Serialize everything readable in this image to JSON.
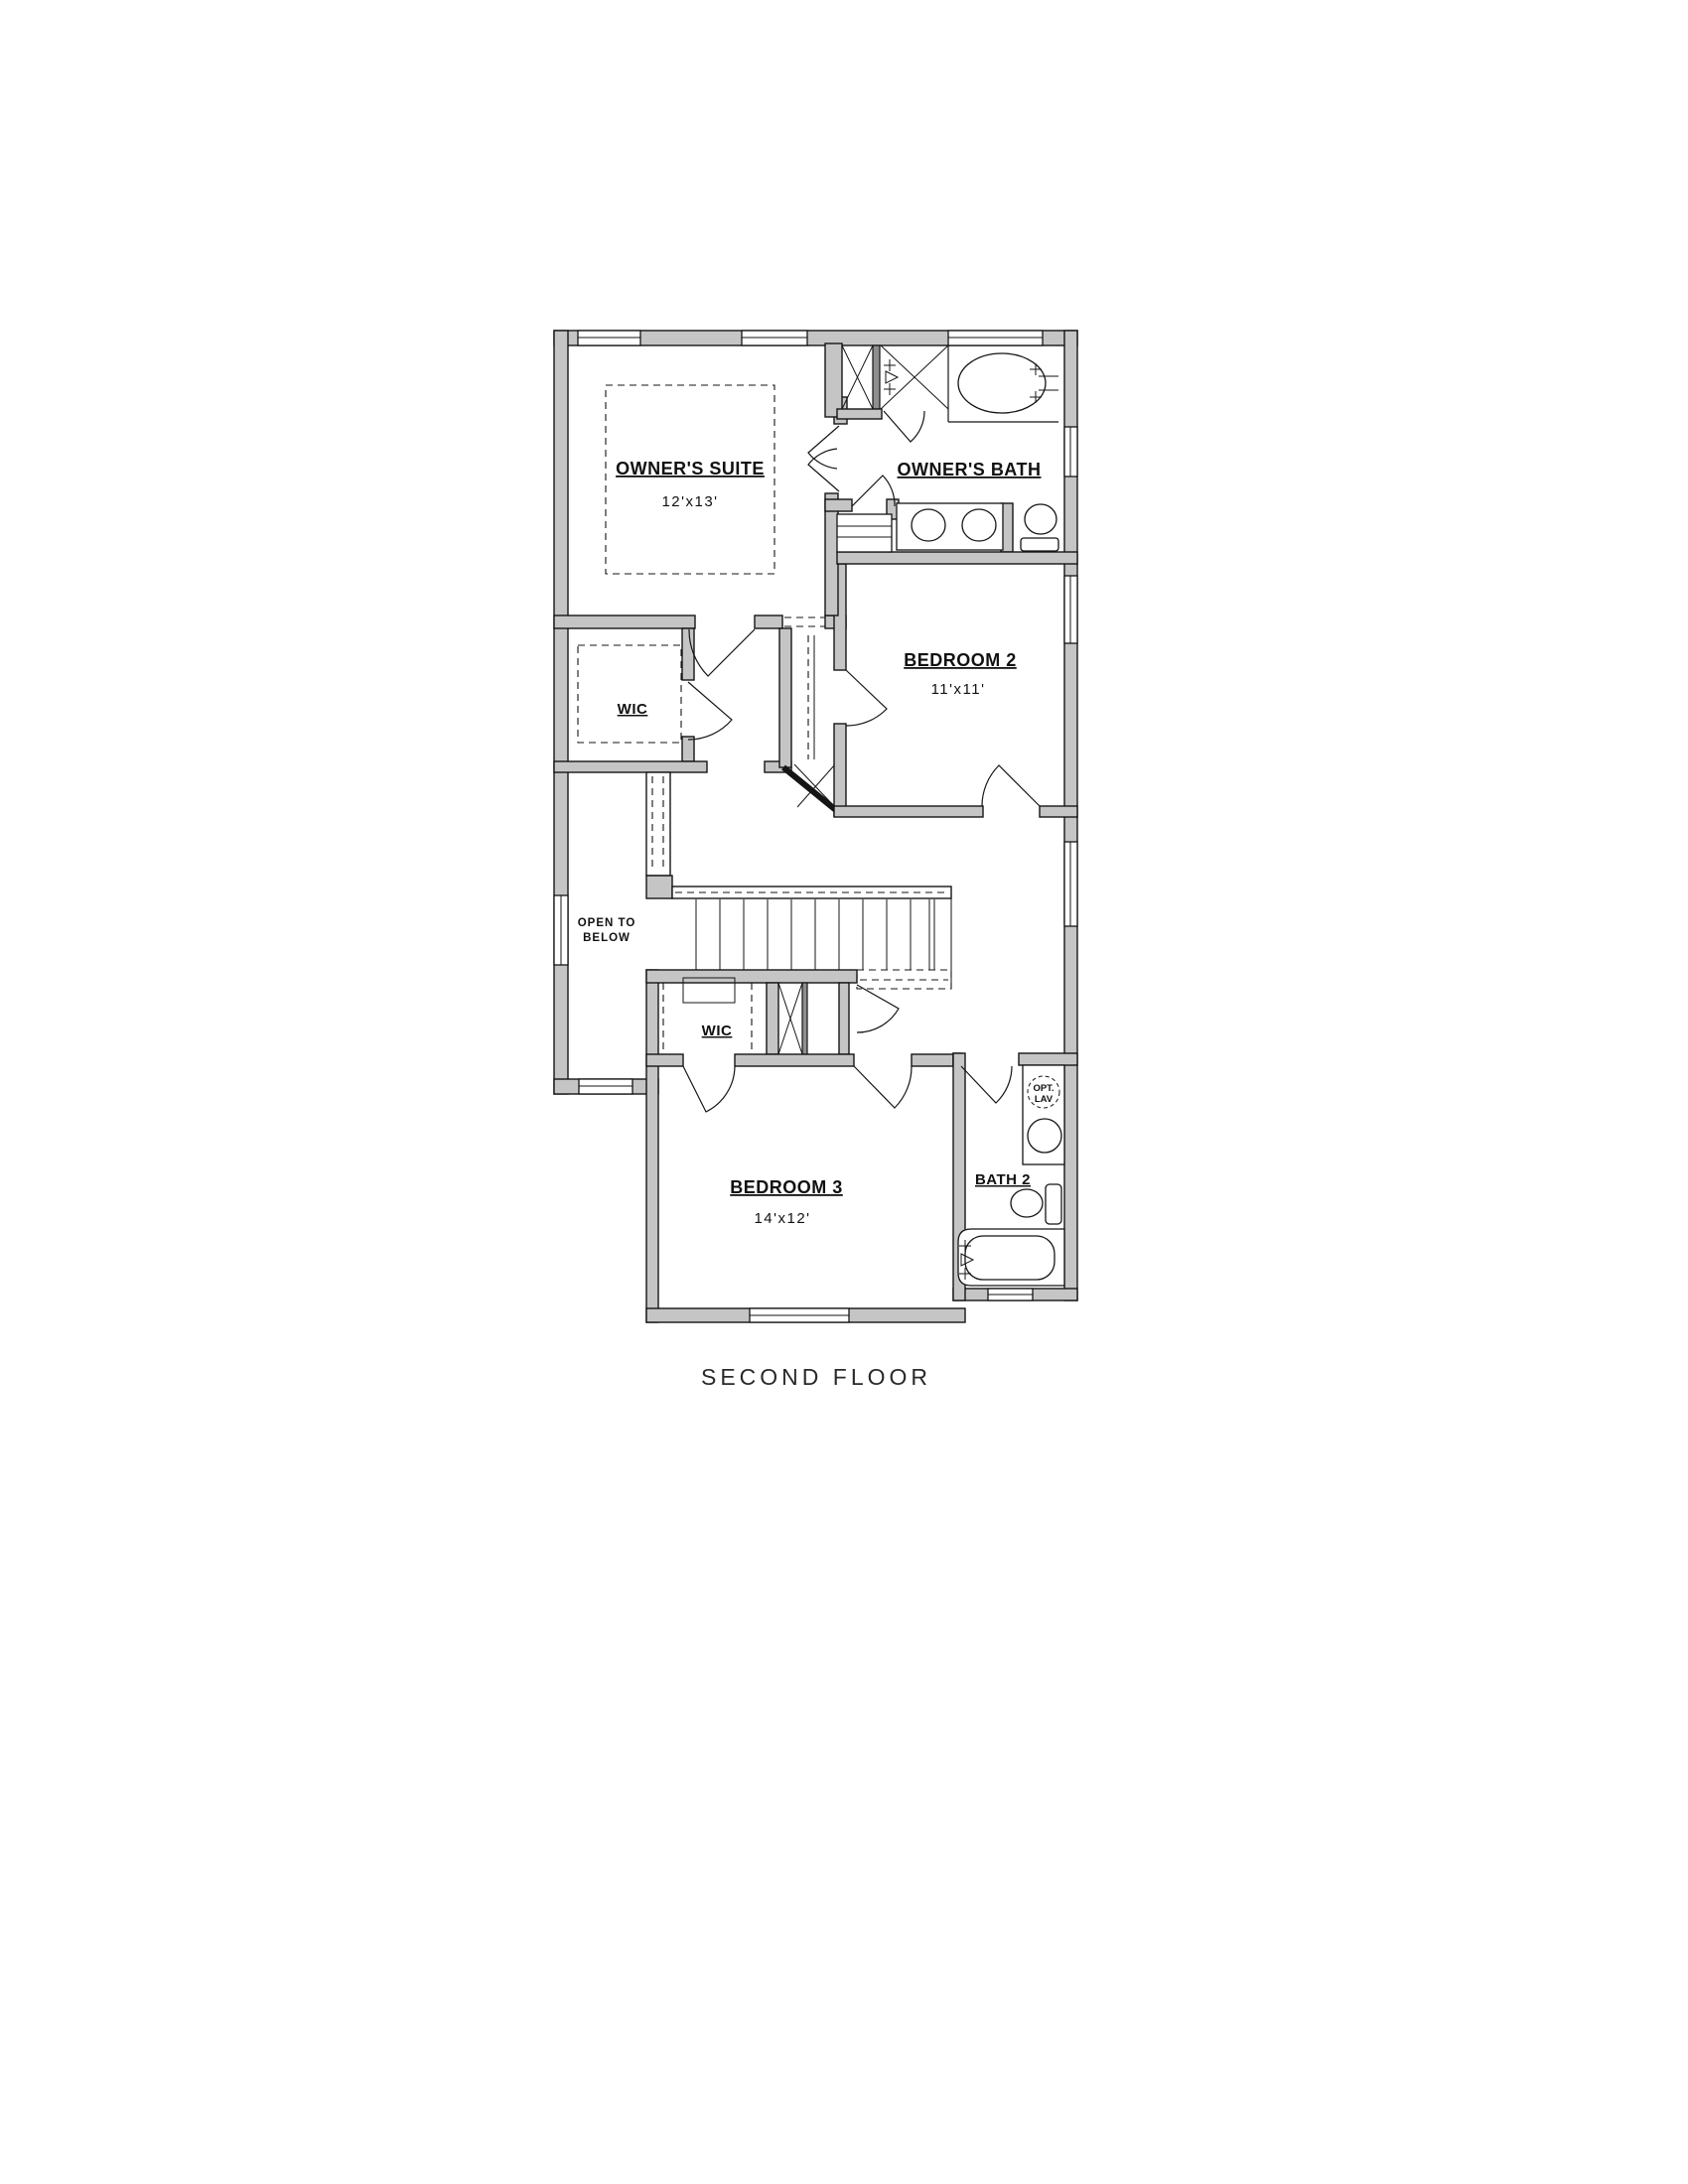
{
  "drawing": {
    "caption": "SECOND FLOOR",
    "colors": {
      "wall_fill": "#c5c5c5",
      "line_color": "#151515",
      "background": "#ffffff"
    },
    "rooms": {
      "owners_suite": {
        "label": "OWNER'S SUITE",
        "dims": "12'x13'"
      },
      "owners_bath": {
        "label": "OWNER'S BATH"
      },
      "bedroom2": {
        "label": "BEDROOM 2",
        "dims": "11'x11'"
      },
      "wic_owners": {
        "label": "WIC"
      },
      "open_to_below": {
        "label_line1": "OPEN TO",
        "label_line2": "BELOW"
      },
      "wic_bedroom3": {
        "label": "WIC"
      },
      "bedroom3": {
        "label": "BEDROOM 3",
        "dims": "14'x12'"
      },
      "bath2": {
        "label": "BATH 2",
        "optional_lav_line1": "OPT.",
        "optional_lav_line2": "LAV"
      }
    }
  }
}
